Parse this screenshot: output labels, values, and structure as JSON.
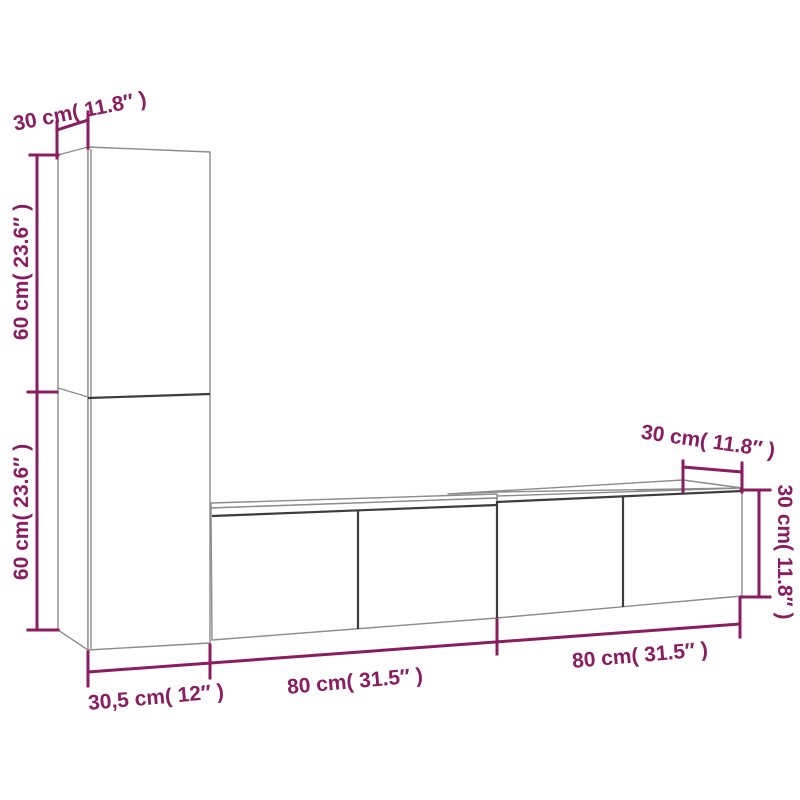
{
  "diagram": {
    "type": "furniture-dimension-drawing",
    "subject": "wall-mounted TV cabinet set with tall side cabinet and two low units",
    "colors": {
      "background": "#ffffff",
      "dimension": "#8a1c62",
      "outline": "#8c8c8c",
      "dark_edge": "#3d3d3d"
    },
    "labels": {
      "top_depth": "30 cm( 11.8″ )",
      "upper_height": "60 cm( 23.6″ )",
      "lower_height": "60 cm( 23.6″ )",
      "base_width": "30,5 cm( 12″ )",
      "left_unit_width": "80 cm( 31.5″ )",
      "right_unit_width": "80 cm( 31.5″ )",
      "right_depth": "30 cm( 11.8″ )",
      "right_height": "30 cm( 11.8″ )"
    },
    "dimensions": [
      {
        "part": "tall-cabinet-depth",
        "cm": "30",
        "inches": "11.8"
      },
      {
        "part": "tall-cabinet-upper-section-height",
        "cm": "60",
        "inches": "23.6"
      },
      {
        "part": "tall-cabinet-lower-section-height",
        "cm": "60",
        "inches": "23.6"
      },
      {
        "part": "tall-cabinet-width",
        "cm": "30,5",
        "inches": "12"
      },
      {
        "part": "left-tv-unit-width",
        "cm": "80",
        "inches": "31.5"
      },
      {
        "part": "right-tv-unit-width",
        "cm": "80",
        "inches": "31.5"
      },
      {
        "part": "tv-unit-depth",
        "cm": "30",
        "inches": "11.8"
      },
      {
        "part": "tv-unit-height",
        "cm": "30",
        "inches": "11.8"
      }
    ]
  }
}
